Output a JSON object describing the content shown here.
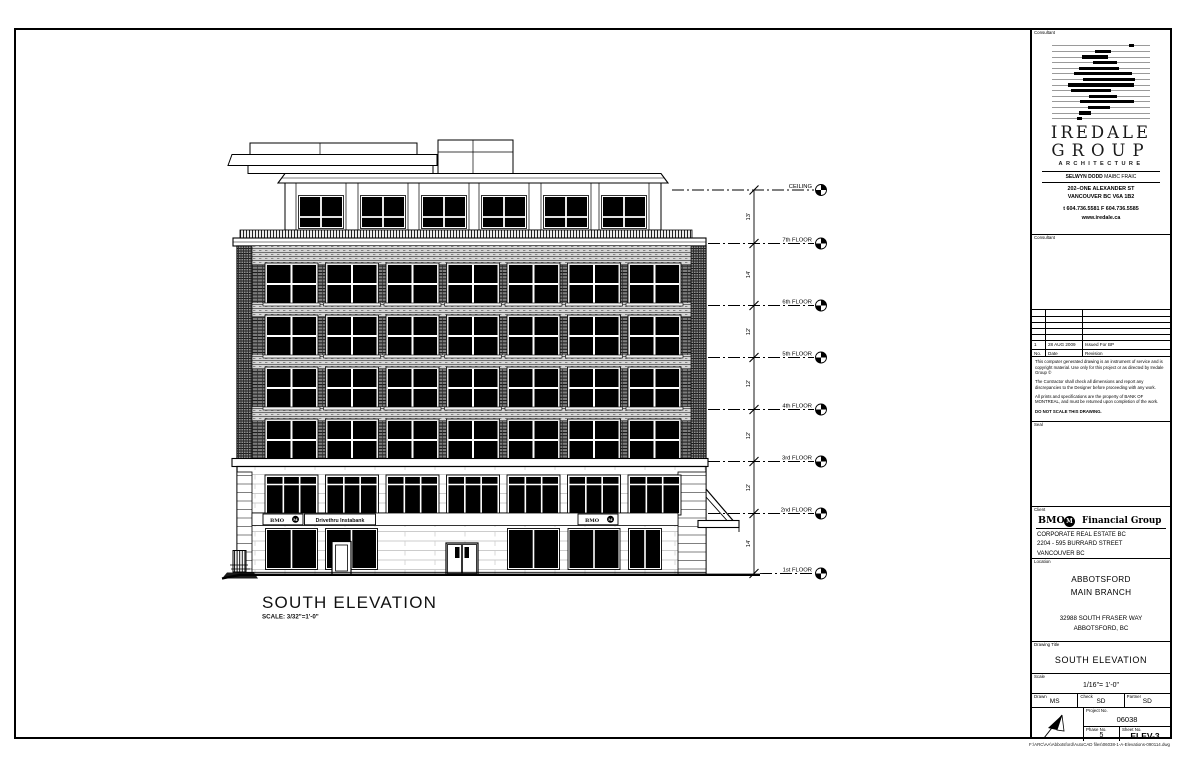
{
  "sheet": {
    "file_path": "F:\\ARC\\AA\\Abbotsford\\AutoCAD files\\06038-1-A-Elevations-090114.dwg"
  },
  "elevation": {
    "title": "SOUTH ELEVATION",
    "scale_note": "SCALE: 3/32\"=1'-0\"",
    "floors": [
      "CEILING",
      "7th FLOOR",
      "6th FLOOR",
      "5th FLOOR",
      "4th FLOOR",
      "3rd FLOOR",
      "2nd FLOOR",
      "1st FLOOR"
    ],
    "floor_dims": [
      "13'",
      "14'",
      "12'",
      "12'",
      "12'",
      "12'",
      "14'"
    ],
    "signs": {
      "bmo_left": "BMO",
      "bmo_right": "BMO",
      "drivethru": "Drivethru Instabank",
      "roundel_letter": "M"
    }
  },
  "titleblock": {
    "consultant_label": "Consultant",
    "consultant2_label": "Consultant",
    "consultant": {
      "firm_line1": "IREDALE",
      "firm_line2": "GROUP",
      "firm_line3": "ARCHITECTURE",
      "principal_name": "SELWYN DODD",
      "principal_cred": "  MAIBC FRAIC",
      "address1": "202–ONE ALEXANDER ST",
      "address2": "VANCOUVER BC V6A 1B2",
      "phone": "t 604.736.5581   F 604.736.5585",
      "web": "www.iredale.ca"
    },
    "revisions": {
      "col_no": "No.",
      "col_date": "Date",
      "col_revision": "Revision",
      "row1_no": "1",
      "row1_date": "28 AUG 2009",
      "row1_revision": "Issued For BP"
    },
    "notes": [
      "This computer generated drawing is an instrument of service and is copyright material.  Use only for this project or as directed by Iredale Group  ©",
      "The Contractor shall check all dimensions and report any discrepancies to the Designer before proceeding with any work.",
      "All prints and specifications are the property of BANK OF MONTREAL, and must be returned upon completion of the work.",
      "DO NOT SCALE THIS DRAWING."
    ],
    "seal_label": "Seal",
    "client_label": "Client",
    "client": {
      "logo_bmo": "BMO",
      "logo_m": "M",
      "logo_rest": "Financial Group",
      "line1": "CORPORATE REAL ESTATE  BC",
      "line2": "2204 - 595 BURRARD STREET",
      "line3": "VANCOUVER  BC"
    },
    "location_label": "Location",
    "location": {
      "name1": "ABBOTSFORD",
      "name2": "MAIN BRANCH",
      "addr1": "32988 SOUTH FRASER WAY",
      "addr2": "ABBOTSFORD, BC"
    },
    "drawing_title_label": "Drawing Title",
    "drawing_title": "SOUTH ELEVATION",
    "scale_label": "Scale",
    "scale_value": "1/16\"= 1'-0\"",
    "drawn_label": "Drawn",
    "drawn": "MS",
    "check_label": "Check",
    "check": "SD",
    "partner_label": "Partner",
    "partner": "SD",
    "project_no_label": "Project No.",
    "project_no": "06038",
    "phase_no_label": "Phase No.",
    "phase_no": "5",
    "sheet_no_label": "Sheet No.",
    "sheet_no": "ELEV-3"
  }
}
